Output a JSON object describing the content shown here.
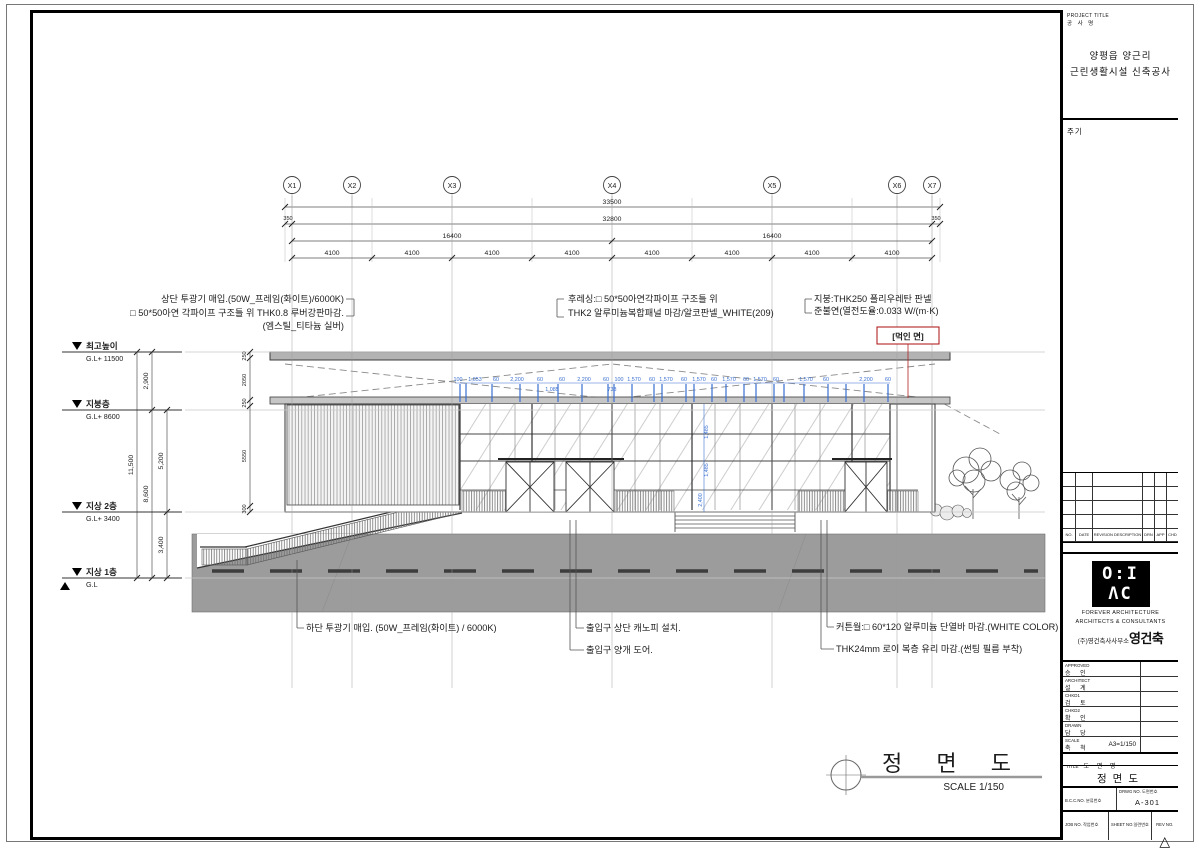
{
  "colors": {
    "dim_blue": "#3a6fd0",
    "highlight_red": "#b22222",
    "road_gray": "#9c9c9c",
    "band_gray": "#b3b3b3"
  },
  "drawing": {
    "grid_labels": [
      "X1",
      "X2",
      "X3",
      "X4",
      "X5",
      "X6",
      "X7"
    ],
    "dims": {
      "total": "33500",
      "body": "32800",
      "parapet_left": "350",
      "parapet_right": "350",
      "halves": [
        "16400",
        "16400"
      ],
      "bays": [
        "4100",
        "4100",
        "4100",
        "4100",
        "4100",
        "4100",
        "4100",
        "4100"
      ],
      "height_total": "11,500",
      "height_upper": "2,900",
      "height_roof": "8,600",
      "height_mid": "5,200",
      "height_lower": "3,400",
      "left_small": [
        "250",
        "2050",
        "250",
        "5550",
        "300"
      ],
      "mullions": [
        "100",
        "1,653",
        "60",
        "2,200",
        "60",
        "60",
        "2,200",
        "60",
        "100",
        "1,570",
        "60",
        "1,570",
        "60",
        "1,570",
        "60",
        "1,570",
        "60",
        "1,570",
        "60",
        "1,570",
        "60",
        "2,200",
        "60"
      ],
      "mullions_lower": [
        "1,085",
        "733"
      ],
      "vertical": [
        "1,485",
        "1,485",
        "2,400"
      ]
    },
    "markers": [
      {
        "name": "최고높이",
        "gl": "G.L+ 11500"
      },
      {
        "name": "지붕층",
        "gl": "G.L+ 8600"
      },
      {
        "name": "지상 2층",
        "gl": "G.L+ 3400"
      },
      {
        "name": "지상 1층",
        "gl": "G.L"
      }
    ],
    "annotations": {
      "tl1": "상단 투광기 매입.(50W_프레임(화이트)/6000K)",
      "tl2": "□ 50*50아연 각파이프 구조틀 위 THK0.8 루버강판마감.",
      "tl3": "(엠스틸_티타늄 실버)",
      "tm1": "후레싱:□ 50*50아연각파이프 구조틀 위",
      "tm2": "THK2 알루미늄복합패널 마감/알코판넬_WHITE(209)",
      "tr1": "지붕:THK250 폴리우레탄 판넬",
      "tr2": "준불연(열전도율:0.033 W/(m·K)",
      "redbox": "[먹인 면]",
      "bl1": "하단 투광기 매입. (50W_프레임(화이트) / 6000K)",
      "bm1": "출입구 상단 캐노피 설치.",
      "bm2": "출입구 양개 도어.",
      "br1": "커튼월:□ 60*120 알루미늄 단열바 마감.(WHITE COLOR)",
      "br2": "THK24mm 로이 복층 유리 마감.(썬팅 필름 부착)"
    },
    "title": "정 면 도",
    "scale_label": "SCALE  1/150"
  },
  "titleblock": {
    "project_label_en": "PROJECT TITLE",
    "project_label_kr": "공 사 명",
    "project_name_line1": "양평읍 양근리",
    "project_name_line2": "근린생활시설 신축공사",
    "notes_label": "주기",
    "revision_headers": [
      "NO.",
      "DATE",
      "REVISION DESCRIPTION",
      "DRN",
      "APP",
      "CHD"
    ],
    "firm": {
      "logo_top": "O:I",
      "logo_bottom": "ΛC",
      "en1": "FOREVER ARCHITECTURE",
      "en2": "ARCHITECTS & CONSULTANTS",
      "kr_office": "(주)영건축사사무소",
      "kr_logo": "영건축"
    },
    "signoff": [
      {
        "en": "APPROVED",
        "kr": "승 인",
        "value": ""
      },
      {
        "en": "ARCHITECT",
        "kr": "설 계",
        "value": ""
      },
      {
        "en": "CHKD1",
        "kr": "검 토",
        "value": ""
      },
      {
        "en": "CHKD2",
        "kr": "확 인",
        "value": ""
      },
      {
        "en": "DRAWN",
        "kr": "담 당",
        "value": ""
      },
      {
        "en": "SCALE",
        "kr": "축 척",
        "value": "A3=1/150"
      }
    ],
    "title_label_en": "TITLE",
    "title_label_kr": "도 면 명",
    "drawing_title": "정면도",
    "bcc": {
      "en": "B.C.C.NO.",
      "kr": "분류번호",
      "value": ""
    },
    "drwg": {
      "en": "DRWG NO.",
      "kr": "도면번호",
      "value": "A-301"
    },
    "job": {
      "en": "JOB NO.",
      "kr": "작업번호",
      "value": ""
    },
    "sheetno": {
      "en": "SHEET NO.",
      "kr": "일련번호",
      "value": ""
    },
    "rev": {
      "en": "REV NO.",
      "icon": "△"
    }
  }
}
